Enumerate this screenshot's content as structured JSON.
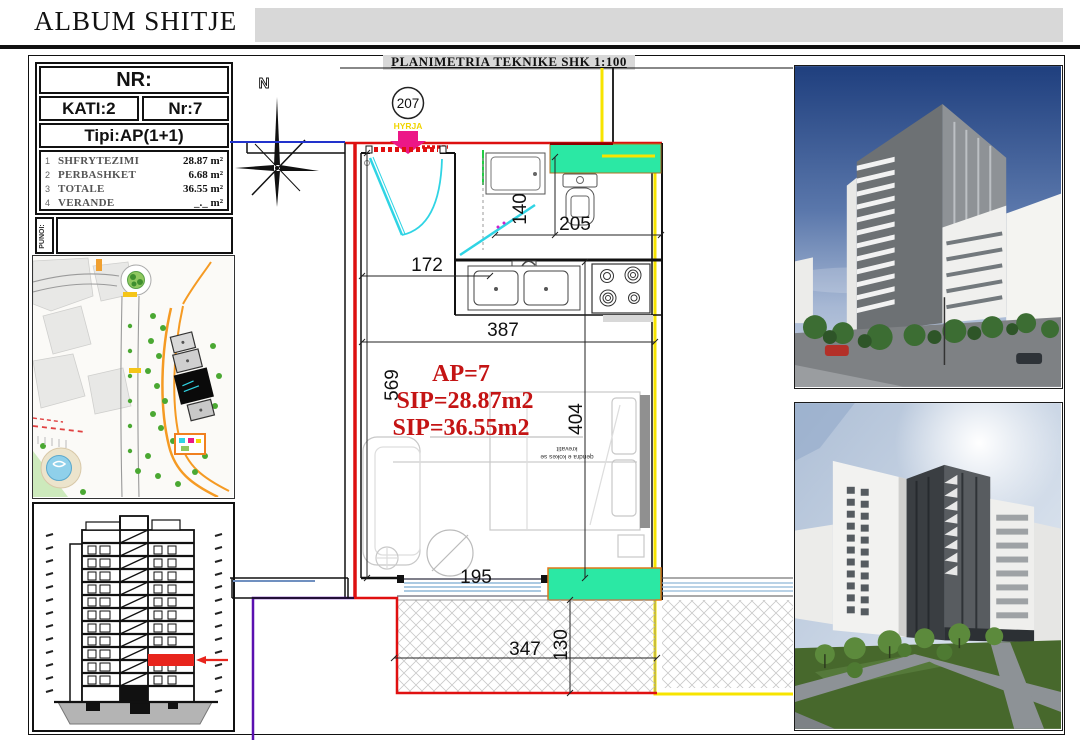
{
  "header": {
    "title": "ALBUM SHITJE"
  },
  "plan": {
    "title": "PLANIMETRIA TEKNIKE SHK 1:100",
    "unit_circle": "207",
    "compass_label": "N",
    "entry_label": "HYRJA",
    "room_labels": {
      "ap": "AP=7",
      "sip1": "SIP=28.87m2",
      "sip2": "SIP=36.55m2"
    },
    "dims": {
      "d140": "140",
      "d205": "205",
      "d172": "172",
      "d387": "387",
      "d569": "569",
      "d404": "404",
      "d195": "195",
      "d347": "347",
      "d130": "130"
    },
    "bed_note_line1": "qendra e kokes se",
    "bed_note_line2": "krevatit"
  },
  "info_card": {
    "nr_label": "NR:",
    "kati": "KATI:2",
    "nr": "Nr:7",
    "tipi": "Tipi:AP(1+1)",
    "rows": [
      {
        "num": "1",
        "label": "SHFRYTEZIMI",
        "value": "28.87 m²"
      },
      {
        "num": "2",
        "label": "PERBASHKET",
        "value": "6.68 m²"
      },
      {
        "num": "3",
        "label": "TOTALE",
        "value": "36.55 m²"
      },
      {
        "num": "4",
        "label": "VERANDE",
        "value": "_._  m²"
      }
    ],
    "punoi": "PUNOI:"
  },
  "colors": {
    "accent_green": "#2be8a4",
    "pipe_yellow": "#f7e400",
    "wall_red": "#e01010",
    "entry_pink": "#ec1787",
    "door_cyan": "#2fd4e4",
    "utility_purple": "#5a10b0",
    "boundary_blue": "#2233cc",
    "label_red": "#c41414"
  }
}
